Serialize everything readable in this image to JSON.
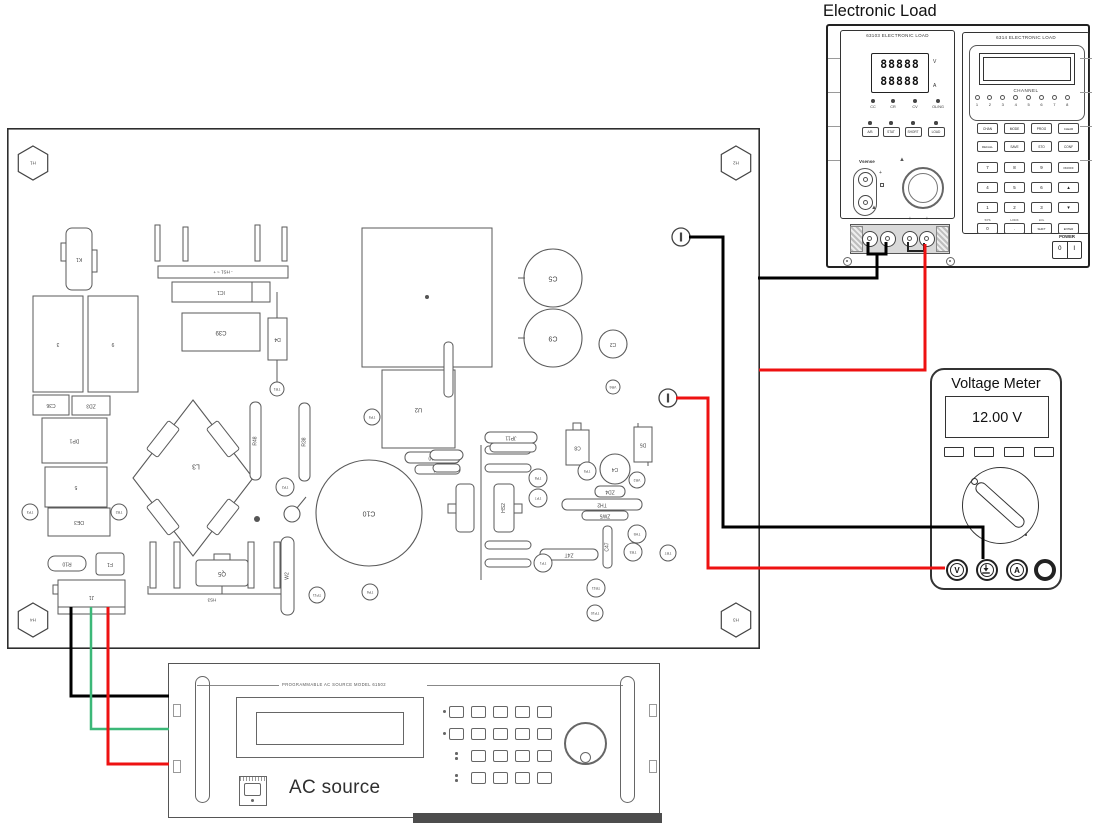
{
  "electronic_load": {
    "title": "Electronic Load",
    "left_module": {
      "model": "63103 ELECTRONIC LOAD",
      "display_line1": "88888",
      "display_line2": "88888",
      "unit_top": "V",
      "unit_bottom": "A",
      "mode_leds": [
        "CC",
        "CR",
        "CV",
        "OL/NG"
      ],
      "buttons": [
        "A/B",
        "STAT",
        "SHORT",
        "LOAD"
      ],
      "vsense_label": "Vsense",
      "terminal_marks": [
        "−",
        "−",
        "+",
        "+"
      ]
    },
    "right_module": {
      "model": "6314 ELECTRONIC LOAD",
      "channel_label": "CHANNEL",
      "channel_numbers": [
        "1",
        "2",
        "3",
        "4",
        "5",
        "6",
        "7",
        "8"
      ],
      "keypad_rows": [
        [
          "CHAN",
          "MODE",
          "PROG",
          "CLEAR"
        ],
        [
          "RECALL",
          "SAVE",
          "STO",
          "CONF"
        ],
        [
          "7",
          "8",
          "9",
          "ON/OFF"
        ],
        [
          "4",
          "5",
          "6",
          "▲"
        ],
        [
          "1",
          "2",
          "3",
          "▼"
        ],
        [
          "0",
          ".",
          "SHIFT",
          "ENTER"
        ]
      ],
      "shift_labels": [
        "SYS",
        "LOCK",
        "LCL"
      ],
      "power_label": "POWER",
      "power_off": "0",
      "power_on": "I"
    }
  },
  "voltage_meter": {
    "title": "Voltage Meter",
    "reading": "12.00 V",
    "function_buttons": [
      "",
      "",
      "",
      ""
    ],
    "jacks": [
      "V",
      "GND",
      "A",
      ""
    ]
  },
  "ac_source": {
    "header": "PROGRAMMABLE  AC  SOURCE   MODEL   61502",
    "label": "AC source"
  },
  "colors": {
    "wire_black": "#000000",
    "wire_red": "#ee1111",
    "wire_green": "#3cb878",
    "outline": "#5a5a5a"
  },
  "wires": [
    {
      "name": "load-neg-jumper",
      "color": "#000000",
      "w": 3,
      "pts": [
        [
          868,
          242
        ],
        [
          868,
          254
        ],
        [
          886,
          254
        ],
        [
          886,
          242
        ]
      ]
    },
    {
      "name": "load-neg-to-board",
      "color": "#000000",
      "w": 3,
      "pts": [
        [
          877,
          254
        ],
        [
          877,
          278
        ],
        [
          758,
          278
        ]
      ]
    },
    {
      "name": "load-pos-jumper",
      "color": "#222222",
      "w": 2,
      "pts": [
        [
          908,
          242
        ],
        [
          908,
          251
        ],
        [
          924,
          251
        ],
        [
          924,
          243
        ]
      ]
    },
    {
      "name": "load-pos-to-board",
      "color": "#ee1111",
      "w": 3,
      "pts": [
        [
          925,
          244
        ],
        [
          925,
          370
        ],
        [
          759,
          370
        ]
      ]
    },
    {
      "name": "board-neg-to-meter-com",
      "color": "#000000",
      "w": 3,
      "pts": [
        [
          689,
          237
        ],
        [
          723,
          237
        ],
        [
          723,
          527
        ],
        [
          983,
          527
        ],
        [
          983,
          559
        ]
      ]
    },
    {
      "name": "board-pos-to-meter-v",
      "color": "#ee1111",
      "w": 3,
      "pts": [
        [
          676,
          398
        ],
        [
          708,
          398
        ],
        [
          708,
          568
        ],
        [
          945,
          568
        ]
      ]
    },
    {
      "name": "ac-line-black",
      "color": "#000000",
      "w": 3,
      "pts": [
        [
          71,
          607
        ],
        [
          71,
          696
        ],
        [
          169,
          696
        ]
      ]
    },
    {
      "name": "ac-line-green",
      "color": "#3cb878",
      "w": 2.5,
      "pts": [
        [
          91,
          607
        ],
        [
          91,
          729
        ],
        [
          169,
          729
        ]
      ]
    },
    {
      "name": "ac-line-red",
      "color": "#ee1111",
      "w": 3,
      "pts": [
        [
          108,
          607
        ],
        [
          108,
          764
        ],
        [
          169,
          764
        ]
      ]
    }
  ],
  "pcb": {
    "board": {
      "x": 7,
      "y": 128,
      "w": 753,
      "h": 521
    },
    "components": [
      {
        "t": "hex",
        "cx": 33,
        "cy": 163,
        "r": 17,
        "l": "H1"
      },
      {
        "t": "hex",
        "cx": 736,
        "cy": 163,
        "r": 17,
        "l": "H2"
      },
      {
        "t": "hex",
        "cx": 736,
        "cy": 620,
        "r": 17,
        "l": "H3"
      },
      {
        "t": "hex",
        "cx": 33,
        "cy": 620,
        "r": 17,
        "l": "H4"
      },
      {
        "t": "rect",
        "x": 66,
        "y": 228,
        "w": 26,
        "h": 62,
        "rx": 6,
        "l": "K1",
        "f": 1
      },
      {
        "t": "rect",
        "x": 61,
        "y": 243,
        "w": 5,
        "h": 18
      },
      {
        "t": "rect",
        "x": 92,
        "y": 250,
        "w": 5,
        "h": 22
      },
      {
        "t": "rect",
        "x": 33,
        "y": 296,
        "w": 50,
        "h": 96,
        "l": "3",
        "f": 1
      },
      {
        "t": "rect",
        "x": 88,
        "y": 296,
        "w": 50,
        "h": 96,
        "l": "9",
        "f": 1
      },
      {
        "t": "rect",
        "x": 33,
        "y": 395,
        "w": 36,
        "h": 20,
        "l": "C36",
        "f": 1
      },
      {
        "t": "rect",
        "x": 72,
        "y": 396,
        "w": 38,
        "h": 19,
        "l": "ZD3",
        "f": 1
      },
      {
        "t": "rect",
        "x": 42,
        "y": 418,
        "w": 65,
        "h": 45,
        "l": "DP1",
        "f": 1
      },
      {
        "t": "rect",
        "x": 45,
        "y": 467,
        "w": 62,
        "h": 40,
        "l": "5",
        "f": 1
      },
      {
        "t": "rect",
        "x": 48,
        "y": 508,
        "w": 62,
        "h": 28,
        "l": "DE3",
        "f": 1
      },
      {
        "t": "tp",
        "cx": 30,
        "cy": 512,
        "r": 8,
        "l": "TP3"
      },
      {
        "t": "tp",
        "cx": 119,
        "cy": 512,
        "r": 8,
        "l": "TR2"
      },
      {
        "t": "rect",
        "x": 48,
        "y": 556,
        "w": 38,
        "h": 15,
        "rx": 7,
        "l": "R10",
        "f": 1
      },
      {
        "t": "rect",
        "x": 96,
        "y": 553,
        "w": 28,
        "h": 22,
        "rx": 3,
        "l": "F1",
        "f": 1
      },
      {
        "t": "rect",
        "x": 58,
        "y": 580,
        "w": 67,
        "h": 34,
        "l": "J1",
        "f": 1
      },
      {
        "t": "rect",
        "x": 58,
        "y": 607,
        "w": 67,
        "h": 7
      },
      {
        "t": "rect",
        "x": 53,
        "y": 585,
        "w": 5,
        "h": 9
      },
      {
        "t": "rect",
        "x": 155,
        "y": 225,
        "w": 5,
        "h": 36
      },
      {
        "t": "rect",
        "x": 183,
        "y": 227,
        "w": 5,
        "h": 34
      },
      {
        "t": "rect",
        "x": 255,
        "y": 225,
        "w": 5,
        "h": 36
      },
      {
        "t": "rect",
        "x": 282,
        "y": 227,
        "w": 5,
        "h": 34
      },
      {
        "t": "rect",
        "x": 158,
        "y": 266,
        "w": 130,
        "h": 12,
        "l": "- HS1 ~ +",
        "f": 1,
        "fs": 4.5
      },
      {
        "t": "rect",
        "x": 172,
        "y": 282,
        "w": 98,
        "h": 20,
        "l": "IC1",
        "f": 1
      },
      {
        "t": "line",
        "pts": [
          [
            252,
            282
          ],
          [
            252,
            302
          ]
        ]
      },
      {
        "t": "rect",
        "x": 182,
        "y": 313,
        "w": 78,
        "h": 38,
        "l": "C39",
        "f": 1,
        "fs": 6
      },
      {
        "t": "line",
        "pts": [
          [
            277,
            292
          ],
          [
            277,
            385
          ]
        ]
      },
      {
        "t": "rect",
        "x": 268,
        "y": 318,
        "w": 19,
        "h": 42,
        "l": "D4",
        "f": 1
      },
      {
        "t": "tp",
        "cx": 277,
        "cy": 389,
        "r": 7,
        "l": "TR1"
      },
      {
        "t": "rect",
        "x": 362,
        "y": 228,
        "w": 130,
        "h": 139
      },
      {
        "t": "dot",
        "cx": 427,
        "cy": 297,
        "r": 2
      },
      {
        "t": "rect",
        "x": 382,
        "y": 370,
        "w": 73,
        "h": 78,
        "l": "U2",
        "f": 1,
        "fs": 6
      },
      {
        "t": "tp",
        "cx": 372,
        "cy": 417,
        "r": 8,
        "l": "TP9"
      },
      {
        "t": "rect",
        "x": 405,
        "y": 452,
        "w": 55,
        "h": 11,
        "rx": 5,
        "l": "J10",
        "f": 1
      },
      {
        "t": "rect",
        "x": 415,
        "y": 465,
        "w": 45,
        "h": 9,
        "rx": 4,
        "l": "TH1",
        "f": 1
      },
      {
        "t": "circ",
        "cx": 553,
        "cy": 278,
        "r": 29,
        "l": "C5",
        "f": 1,
        "fs": 7
      },
      {
        "t": "line",
        "pts": [
          [
            518,
            278
          ],
          [
            525,
            278
          ]
        ]
      },
      {
        "t": "circ",
        "cx": 553,
        "cy": 338,
        "r": 29,
        "l": "C9",
        "f": 1,
        "fs": 7
      },
      {
        "t": "line",
        "pts": [
          [
            518,
            338
          ],
          [
            525,
            338
          ]
        ]
      },
      {
        "t": "circ",
        "cx": 613,
        "cy": 344,
        "r": 14,
        "l": "C2",
        "f": 1
      },
      {
        "t": "tp",
        "cx": 613,
        "cy": 387,
        "r": 7,
        "l": "VR6"
      },
      {
        "t": "poly",
        "pts": [
          [
            193,
            400
          ],
          [
            253,
            478
          ],
          [
            193,
            556
          ],
          [
            133,
            478
          ]
        ],
        "l": "L3",
        "f": 1,
        "lx": 196,
        "ly": 466,
        "fs": 7
      },
      {
        "t": "rot",
        "x": 205,
        "y": 432,
        "w": 36,
        "h": 14,
        "a": 52
      },
      {
        "t": "rot",
        "x": 145,
        "y": 432,
        "w": 36,
        "h": 14,
        "a": -52
      },
      {
        "t": "rot",
        "x": 145,
        "y": 510,
        "w": 36,
        "h": 14,
        "a": 52
      },
      {
        "t": "rot",
        "x": 205,
        "y": 510,
        "w": 36,
        "h": 14,
        "a": -52
      },
      {
        "t": "rect",
        "x": 250,
        "y": 402,
        "w": 11,
        "h": 78,
        "rx": 5,
        "l": "R48",
        "f": 1,
        "lr": 1
      },
      {
        "t": "rect",
        "x": 299,
        "y": 403,
        "w": 11,
        "h": 78,
        "rx": 5,
        "l": "R38",
        "f": 1,
        "lr": 1
      },
      {
        "t": "rect",
        "x": 444,
        "y": 342,
        "w": 9,
        "h": 55,
        "rx": 4
      },
      {
        "t": "tp",
        "cx": 285,
        "cy": 487,
        "r": 9,
        "l": "TP2"
      },
      {
        "t": "circ",
        "cx": 292,
        "cy": 514,
        "r": 8
      },
      {
        "t": "line",
        "pts": [
          [
            297,
            508
          ],
          [
            306,
            497
          ]
        ]
      },
      {
        "t": "dot",
        "cx": 257,
        "cy": 519,
        "r": 3
      },
      {
        "t": "circ",
        "cx": 369,
        "cy": 513,
        "r": 53,
        "l": "C10",
        "f": 1,
        "fs": 7
      },
      {
        "t": "line",
        "pts": [
          [
            481,
            445
          ],
          [
            481,
            580
          ]
        ]
      },
      {
        "t": "rect",
        "x": 485,
        "y": 446,
        "w": 46,
        "h": 8,
        "rx": 4
      },
      {
        "t": "rect",
        "x": 485,
        "y": 464,
        "w": 46,
        "h": 8,
        "rx": 4
      },
      {
        "t": "rect",
        "x": 485,
        "y": 541,
        "w": 46,
        "h": 8,
        "rx": 4
      },
      {
        "t": "rect",
        "x": 485,
        "y": 559,
        "w": 46,
        "h": 8,
        "rx": 4
      },
      {
        "t": "rect",
        "x": 456,
        "y": 484,
        "w": 18,
        "h": 48,
        "rx": 4
      },
      {
        "t": "rect",
        "x": 494,
        "y": 484,
        "w": 20,
        "h": 48,
        "rx": 4,
        "l": "HS2",
        "f": 1,
        "lr": 1
      },
      {
        "t": "rect",
        "x": 448,
        "y": 504,
        "w": 8,
        "h": 9
      },
      {
        "t": "rect",
        "x": 514,
        "y": 504,
        "w": 8,
        "h": 9
      },
      {
        "t": "rect",
        "x": 430,
        "y": 450,
        "w": 33,
        "h": 10,
        "rx": 5
      },
      {
        "t": "rect",
        "x": 433,
        "y": 464,
        "w": 27,
        "h": 8,
        "rx": 4
      },
      {
        "t": "rect",
        "x": 485,
        "y": 432,
        "w": 52,
        "h": 11,
        "rx": 5,
        "l": "JP11",
        "f": 1
      },
      {
        "t": "rect",
        "x": 490,
        "y": 443,
        "w": 46,
        "h": 9,
        "rx": 4
      },
      {
        "t": "rect",
        "x": 573,
        "y": 423,
        "w": 8,
        "h": 7
      },
      {
        "t": "rect",
        "x": 566,
        "y": 430,
        "w": 23,
        "h": 35,
        "l": "C8",
        "f": 1
      },
      {
        "t": "rect",
        "x": 634,
        "y": 427,
        "w": 18,
        "h": 35,
        "l": "D5",
        "f": 1
      },
      {
        "t": "line",
        "pts": [
          [
            638,
            423
          ],
          [
            638,
            427
          ]
        ]
      },
      {
        "t": "line",
        "pts": [
          [
            648,
            462
          ],
          [
            648,
            466
          ]
        ]
      },
      {
        "t": "circ",
        "cx": 615,
        "cy": 469,
        "r": 15,
        "l": "C4",
        "f": 1
      },
      {
        "t": "tp",
        "cx": 587,
        "cy": 471,
        "r": 9,
        "l": "TP5"
      },
      {
        "t": "tp",
        "cx": 637,
        "cy": 480,
        "r": 8,
        "l": "VR2"
      },
      {
        "t": "rect",
        "x": 595,
        "y": 486,
        "w": 30,
        "h": 11,
        "rx": 5,
        "l": "ZD4",
        "f": 1
      },
      {
        "t": "rect",
        "x": 562,
        "y": 499,
        "w": 80,
        "h": 11,
        "rx": 5,
        "l": "TH2",
        "f": 1
      },
      {
        "t": "rect",
        "x": 582,
        "y": 511,
        "w": 46,
        "h": 9,
        "rx": 4,
        "l": "ZW5",
        "f": 1
      },
      {
        "t": "rect",
        "x": 603,
        "y": 526,
        "w": 9,
        "h": 42,
        "rx": 4,
        "l": "C47",
        "f": 1,
        "lr": 1
      },
      {
        "t": "rect",
        "x": 540,
        "y": 549,
        "w": 58,
        "h": 11,
        "rx": 5,
        "l": "Z4T",
        "f": 1
      },
      {
        "t": "tp",
        "cx": 538,
        "cy": 478,
        "r": 9,
        "l": "TP8"
      },
      {
        "t": "tp",
        "cx": 538,
        "cy": 498,
        "r": 9,
        "l": "TP7"
      },
      {
        "t": "tp",
        "cx": 543,
        "cy": 563,
        "r": 9,
        "l": "TP1"
      },
      {
        "t": "tp",
        "cx": 317,
        "cy": 595,
        "r": 8,
        "l": "TP11"
      },
      {
        "t": "tp",
        "cx": 370,
        "cy": 592,
        "r": 8,
        "l": "TP6"
      },
      {
        "t": "tp",
        "cx": 596,
        "cy": 588,
        "r": 9,
        "l": "TR11"
      },
      {
        "t": "tp",
        "cx": 595,
        "cy": 613,
        "r": 8,
        "l": "TP10"
      },
      {
        "t": "tp",
        "cx": 637,
        "cy": 534,
        "r": 9,
        "l": "TH5"
      },
      {
        "t": "tp",
        "cx": 633,
        "cy": 552,
        "r": 9,
        "l": "TR3"
      },
      {
        "t": "tp",
        "cx": 668,
        "cy": 553,
        "r": 8,
        "l": "TR7"
      },
      {
        "t": "rect",
        "x": 150,
        "y": 542,
        "w": 6,
        "h": 46
      },
      {
        "t": "rect",
        "x": 174,
        "y": 542,
        "w": 6,
        "h": 46
      },
      {
        "t": "rect",
        "x": 248,
        "y": 542,
        "w": 6,
        "h": 46
      },
      {
        "t": "rect",
        "x": 274,
        "y": 542,
        "w": 6,
        "h": 46
      },
      {
        "t": "line",
        "pts": [
          [
            148,
            586
          ],
          [
            148,
            594
          ],
          [
            282,
            594
          ],
          [
            282,
            586
          ]
        ]
      },
      {
        "t": "rect",
        "x": 214,
        "y": 554,
        "w": 16,
        "h": 7
      },
      {
        "t": "rect",
        "x": 196,
        "y": 560,
        "w": 52,
        "h": 26,
        "rx": 3,
        "l": "Q5",
        "f": 1,
        "fs": 6
      },
      {
        "t": "line",
        "pts": [
          [
            222,
            586
          ],
          [
            222,
            594
          ]
        ]
      },
      {
        "t": "label",
        "x": 212,
        "y": 600,
        "l": "HS3",
        "f": 1
      },
      {
        "t": "rect",
        "x": 281,
        "y": 537,
        "w": 13,
        "h": 78,
        "rx": 6,
        "l": "W2",
        "f": 1,
        "lr": 1
      },
      {
        "t": "term",
        "cx": 681,
        "cy": 237,
        "l": "E1"
      },
      {
        "t": "term",
        "cx": 668,
        "cy": 398,
        "l": "E2"
      }
    ]
  }
}
